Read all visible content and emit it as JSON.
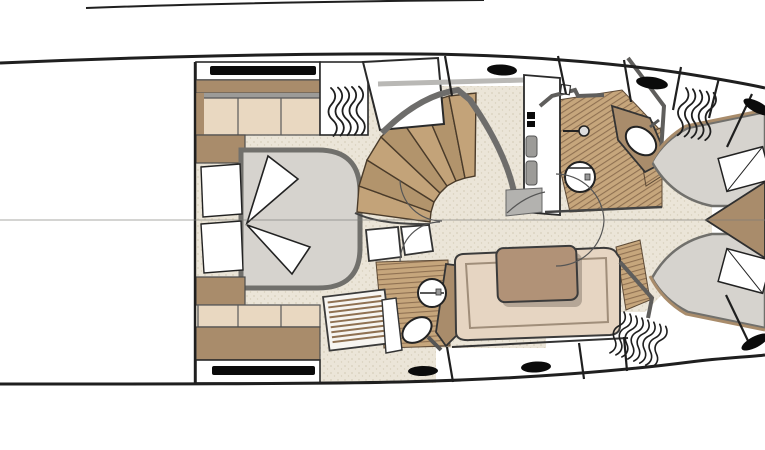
{
  "diagram": {
    "type": "yacht-lower-deck-floorplan",
    "orientation": "bow-left-stern-right"
  },
  "palette": {
    "line": "#1f1f1f",
    "wall_gray": "#9c9b98",
    "wall_dark": "#5f5e5c",
    "carpet": "#ebe5d8",
    "carpet_dot": "#d7cfbc",
    "teak": "#c6a67c",
    "teak_line": "#8f7152",
    "wood": "#a98c6b",
    "wood_dark": "#6e5a42",
    "cream": "#e9d8c1",
    "mattress": "#d6d3ce",
    "mattress_border": "#71706c",
    "sofa_seat": "#e6d5c2",
    "sofa_back": "#b19277",
    "fixture_white": "#ffffff",
    "porthole_black": "#0b0b0b",
    "stair_tread_a": "#c3a379",
    "stair_tread_b": "#b2946c",
    "stair_edge": "#4a3b2a"
  },
  "features": {
    "forward_cabin": [
      "double-bed",
      "pillows",
      "side-cabinets",
      "hull-windows",
      "vent-grille",
      "louvered-panel"
    ],
    "midship": [
      "curved-staircase",
      "companionway-landing",
      "galley-bulkhead",
      "door-swings"
    ],
    "forward_head": [
      "toilet",
      "sink-on-counter",
      "shower-handset",
      "teak-floor"
    ],
    "mid_head": [
      "toilet",
      "sink",
      "vanity-counter",
      "teak-floor",
      "double-doors"
    ],
    "salon": [
      "sofa-with-back-cushion"
    ],
    "aft_cabin": [
      "twin-berth-port",
      "twin-berth-starboard",
      "center-cabinet-wedge",
      "pillows",
      "vent-grilles"
    ]
  },
  "counts": {
    "beds": 3,
    "toilets": 2,
    "sinks": 2,
    "sofas": 1,
    "staircases": 1,
    "vent_grilles": 3,
    "portholes": 6,
    "hull_windows": 2
  }
}
